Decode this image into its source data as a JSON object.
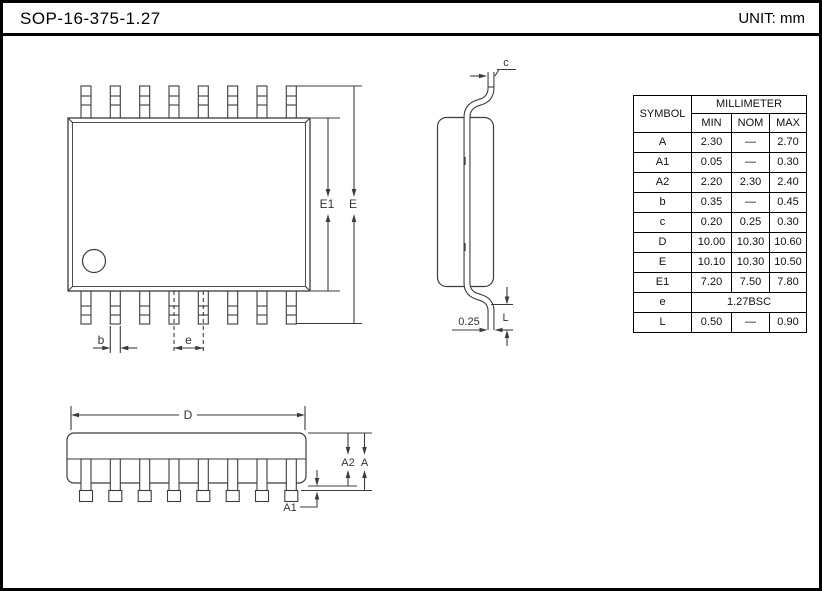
{
  "title": "SOP-16-375-1.27",
  "unit_label": "UNIT: mm",
  "views": {
    "top_view_dims": {
      "E1": "E1",
      "E": "E",
      "b": "b",
      "e": "e"
    },
    "side_view_dims": {
      "c": "c",
      "L": "L",
      "foot_width": "0.25"
    },
    "front_view_dims": {
      "D": "D",
      "A": "A",
      "A1": "A1",
      "A2": "A2"
    }
  },
  "table": {
    "symbol_header": "SYMBOL",
    "unit_header": "MILLIMETER",
    "col_headers": [
      "MIN",
      "NOM",
      "MAX"
    ],
    "rows": [
      {
        "symbol": "A",
        "min": "2.30",
        "nom": "—",
        "max": "2.70"
      },
      {
        "symbol": "A1",
        "min": "0.05",
        "nom": "—",
        "max": "0.30"
      },
      {
        "symbol": "A2",
        "min": "2.20",
        "nom": "2.30",
        "max": "2.40"
      },
      {
        "symbol": "b",
        "min": "0.35",
        "nom": "—",
        "max": "0.45"
      },
      {
        "symbol": "c",
        "min": "0.20",
        "nom": "0.25",
        "max": "0.30"
      },
      {
        "symbol": "D",
        "min": "10.00",
        "nom": "10.30",
        "max": "10.60"
      },
      {
        "symbol": "E",
        "min": "10.10",
        "nom": "10.30",
        "max": "10.50"
      },
      {
        "symbol": "E1",
        "min": "7.20",
        "nom": "7.50",
        "max": "7.80"
      },
      {
        "symbol": "e",
        "span": "1.27BSC"
      },
      {
        "symbol": "L",
        "min": "0.50",
        "nom": "—",
        "max": "0.90"
      }
    ]
  },
  "colors": {
    "line": "#3c3c3c",
    "frame": "#000000",
    "background": "#ffffff"
  }
}
